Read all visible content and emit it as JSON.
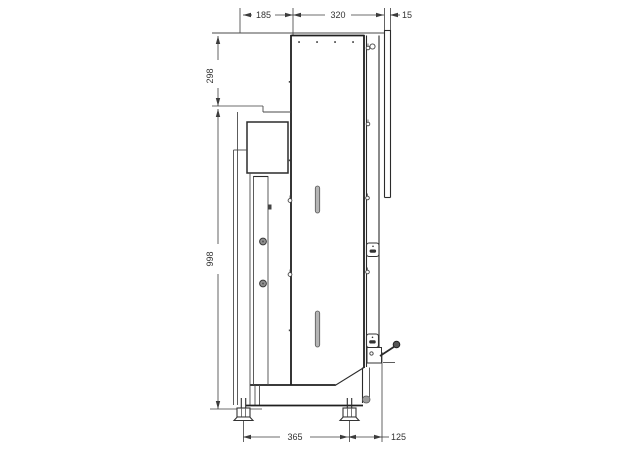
{
  "drawing": {
    "description": "Technical side-view dimension drawing of a cabinet machine",
    "colors": {
      "background": "#ffffff",
      "outline": "#1f1f1f",
      "dimension_line": "#3c3c3c",
      "slot_fill": "#b5b5b5",
      "knob_fill": "#8f8f8f"
    },
    "dims": {
      "top_depth_front": "185",
      "top_depth_body": "320",
      "top_back_panel": "15",
      "left_height_upper": "298",
      "left_height_total": "998",
      "bottom_feet_span": "365",
      "bottom_rear_offset": "125"
    }
  }
}
